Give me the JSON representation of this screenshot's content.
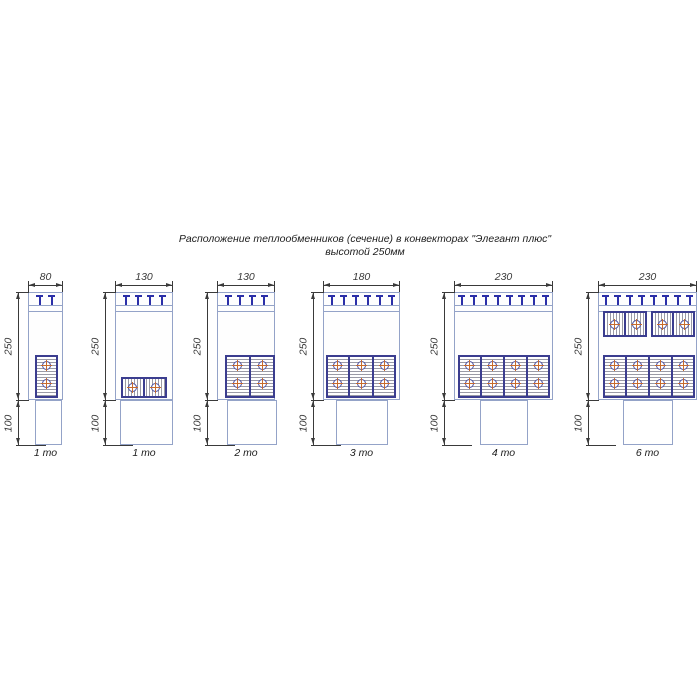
{
  "title": {
    "line1": "Расположение теплообменников (сечение) в конвекторах \"Элегант плюс\"",
    "line2": "высотой 250мм"
  },
  "side_dims": {
    "height": "250",
    "depth": "100"
  },
  "figures": [
    {
      "width_label": "80",
      "type_label": "1 то",
      "grille_clips": 2,
      "exchangers": {
        "vertical_columns": 1,
        "horizontal_bottom_block": false,
        "horizontal_top_blocks": 0
      },
      "tube_count": 2
    },
    {
      "width_label": "130",
      "type_label": "1 то",
      "grille_clips": 4,
      "exchangers": {
        "vertical_columns": 0,
        "horizontal_bottom_block": true,
        "horizontal_top_blocks": 0
      },
      "tube_count": 2
    },
    {
      "width_label": "130",
      "type_label": "2 то",
      "grille_clips": 4,
      "exchangers": {
        "vertical_columns": 2,
        "horizontal_bottom_block": false,
        "horizontal_top_blocks": 0
      },
      "tube_count": 4
    },
    {
      "width_label": "180",
      "type_label": "3 то",
      "grille_clips": 6,
      "exchangers": {
        "vertical_columns": 3,
        "horizontal_bottom_block": false,
        "horizontal_top_blocks": 0
      },
      "tube_count": 6
    },
    {
      "width_label": "230",
      "type_label": "4 то",
      "grille_clips": 8,
      "exchangers": {
        "vertical_columns": 4,
        "horizontal_bottom_block": false,
        "horizontal_top_blocks": 0
      },
      "tube_count": 8
    },
    {
      "width_label": "230",
      "type_label": "6 то",
      "grille_clips": 8,
      "exchangers": {
        "vertical_columns": 4,
        "horizontal_bottom_block": false,
        "horizontal_top_blocks": 2
      },
      "tube_count": 12
    }
  ],
  "colors": {
    "outline": "#94a3c8",
    "grille": "#2b2fa8",
    "block_border": "#3b3d8f",
    "tube_ring": "#4b4fa0",
    "tube_cross": "#c76b2e",
    "dimension": "#3a3a3a",
    "text": "#1c1c1c"
  }
}
